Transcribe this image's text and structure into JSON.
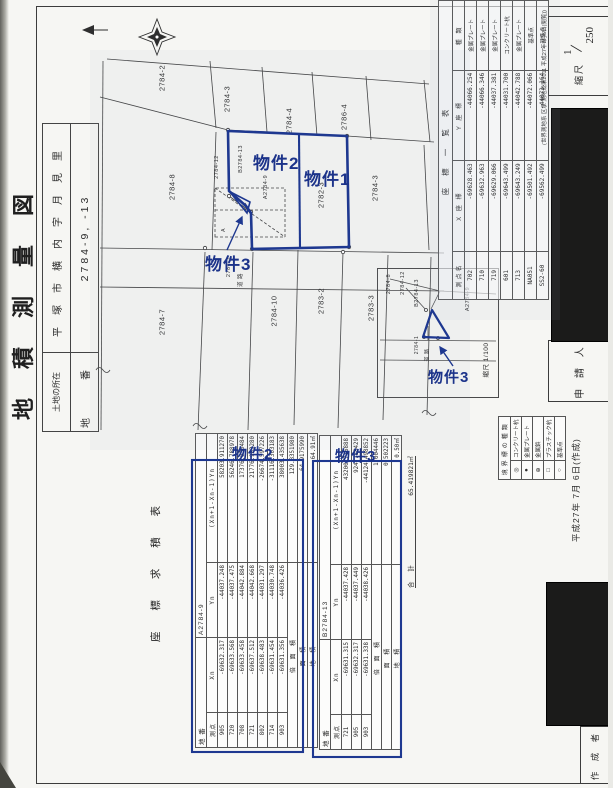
{
  "page": {
    "accent_blue": "#1e3890",
    "paper": "#f6f6f3"
  },
  "document": {
    "title": "地積測量図",
    "location_label": "土地の所在",
    "location_value": "平塚市横内字月見里",
    "parcel_label": "地　番",
    "parcel_value": "2784-9, -13",
    "scale_label": "縮尺",
    "scale_numerator": "1",
    "scale_denominator": "250",
    "applicant_label": "申 請 人",
    "author_label": "作 成 者",
    "date_note": "平成27年 7月 6日(作成)"
  },
  "map": {
    "labels": [
      "2784-2",
      "2784-3",
      "2784-4",
      "2786-4",
      "2784-8",
      "2784-12",
      "B2784-13",
      "A2784-9",
      "2782-3",
      "2784-3",
      "2784-7",
      "2784-1",
      "道 路",
      "2784-10",
      "2783-2",
      "2783-3",
      "A"
    ]
  },
  "inset": {
    "labels": [
      "2784-8",
      "2784-12",
      "B2784-13",
      "A2784-9",
      "2784-1",
      "道 路"
    ],
    "scale_note": "縮尺 1/100"
  },
  "annotations": {
    "property1": "物件1",
    "property2": "物件2",
    "property3": "物件3",
    "table2_title": "物件2",
    "table3_title": "物件3"
  },
  "benchmark_table": {
    "title": "座 標 一 覧 表",
    "headers": [
      "測点名",
      "X 座 標",
      "Y 座 標",
      "種 類"
    ],
    "rows": [
      [
        "702",
        "-69628.463",
        "-44066.254",
        "金属プレート"
      ],
      [
        "710",
        "-69632.963",
        "-44066.346",
        "金属プレート"
      ],
      [
        "719",
        "-69629.066",
        "-44037.381",
        "金属プレート"
      ],
      [
        "601",
        "-69643.499",
        "-44031.700",
        "コンクリート杭"
      ],
      [
        "713",
        "-69643.249",
        "-44042.788",
        "金属プレート"
      ],
      [
        "NA051",
        "-69501.492",
        "-44072.066",
        "基準点"
      ],
      [
        "SS2-60",
        "-69562.499",
        "-44073.164",
        "基準点"
      ]
    ],
    "note": "(世界測地系 区承 測地成果2011 平成27年7月6日(閲覧))"
  },
  "survey": {
    "section_label": "座 標 求 積 表",
    "tables": [
      {
        "title": "物件2",
        "parcel_label": "地 番",
        "parcel": "A2784-9",
        "headers": [
          "測点",
          "Xn",
          "Yn",
          "(Xn+1-Xn-1)Yn"
        ],
        "rows": [
          [
            "905",
            "-69632.317",
            "-44037.248",
            "58203.911270"
          ],
          [
            "720",
            "-69633.568",
            "-44037.475",
            "56246.788978"
          ],
          [
            "708",
            "-69633.458",
            "-44042.884",
            "17376.035484"
          ],
          [
            "721",
            "-69637.512",
            "-44042.668",
            "21776.983280"
          ],
          [
            "802",
            "-69638.483",
            "-44031.297",
            "-26674.597226"
          ],
          [
            "714",
            "-69631.454",
            "-44030.748",
            "-31116.303183"
          ],
          [
            "903",
            "-69631.356",
            "-44036.426",
            "38003.435638"
          ]
        ],
        "summary": [
          [
            "倍 面 積",
            "129.8351980"
          ],
          [
            "面  積",
            "64.9175990"
          ],
          [
            "地  積",
            "64.91㎡"
          ]
        ]
      },
      {
        "title": "物件3",
        "parcel_label": "地 番",
        "parcel": "B2784-13",
        "headers": [
          "測点",
          "Xn",
          "Yn",
          "(Xn+1-Xn-1)Yn"
        ],
        "rows": [
          [
            "721",
            "-69631.315",
            "-44037.428",
            "43200.716888"
          ],
          [
            "905",
            "-69632.317",
            "-44037.449",
            "924.788429"
          ],
          [
            "903",
            "-69631.338",
            "-44038.426",
            "-44124.498852"
          ]
        ],
        "summary": [
          [
            "倍 面 積",
            "1.004446"
          ],
          [
            "面  積",
            "0.502223"
          ],
          [
            "地  積",
            "0.50㎡"
          ]
        ]
      }
    ],
    "total_label": "合  計",
    "total_value": "65.419821㎡"
  },
  "legend": {
    "title": "境界標の種類",
    "items": [
      [
        "◎",
        "コンクリート杭"
      ],
      [
        "●",
        "金属プレート"
      ],
      [
        "⊕",
        "金属鋲"
      ],
      [
        "□",
        "プラスチック杭"
      ],
      [
        "○",
        "基準点"
      ]
    ]
  }
}
